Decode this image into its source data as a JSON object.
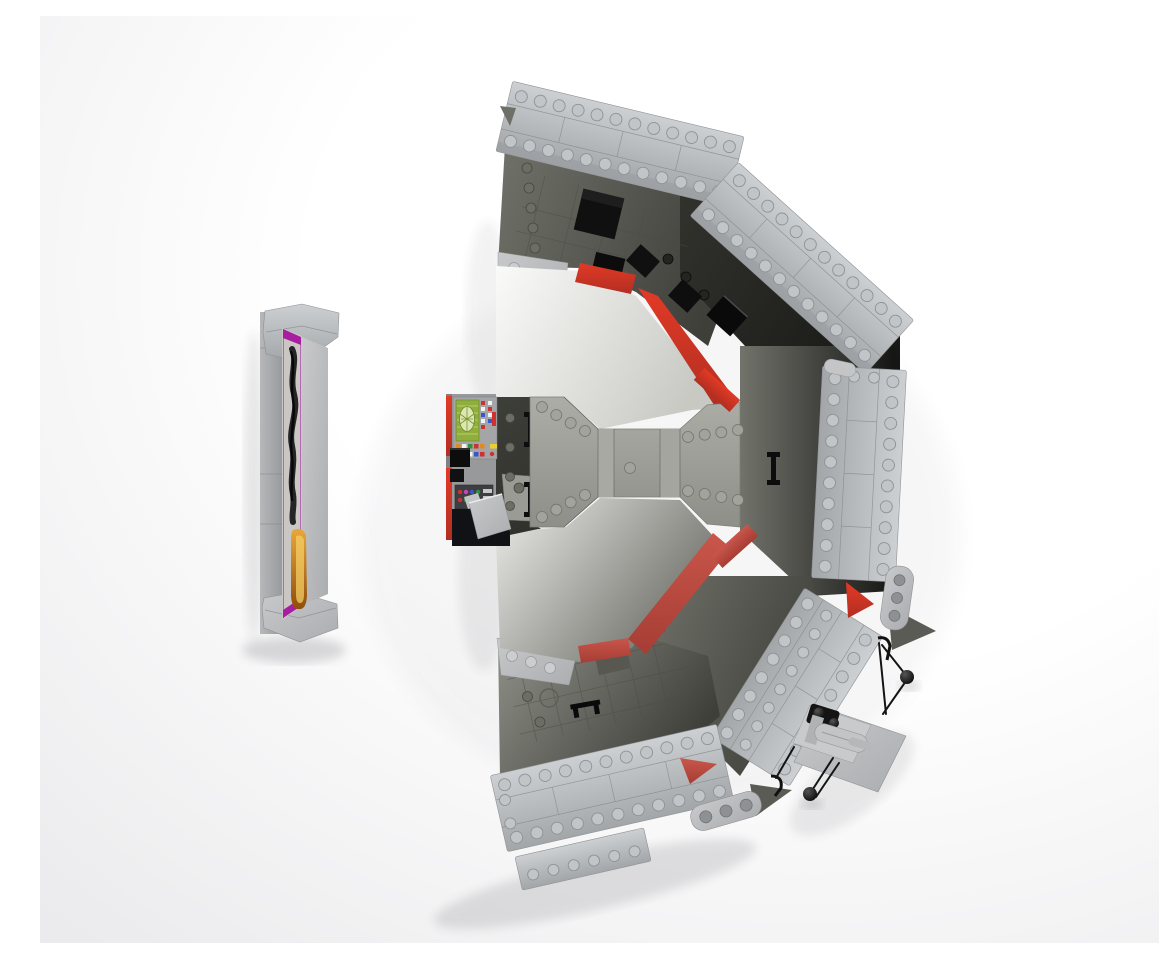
{
  "meta": {
    "type": "3d-render-screenshot",
    "caption": "Top-down 3D render of a gray LEGO diorama: five studded wall segments arranged in a broken ring around a central walkway with red sloped trim, a printed control console with colored buttons, a sensor platform with black ball-tipped antenna rods, and a freestanding panel displaying purple-trimmed artwork of a dark smoke figure above orange flames, on a white studio backdrop."
  },
  "scene": {
    "objects": [
      {
        "name": "artwork-panel",
        "label": "Freestanding gray panel with purple-trimmed artwork: black smoke figure over orange flame"
      },
      {
        "name": "control-console",
        "label": "Printed control console with green gauge screen and colored button tiles"
      },
      {
        "name": "central-walkway",
        "label": "Central studded walkway bridge with red corner slopes"
      },
      {
        "name": "wall-segment-top",
        "label": "Top studded wall segment"
      },
      {
        "name": "wall-segment-upper-right",
        "label": "Upper-right studded wall segment"
      },
      {
        "name": "wall-segment-right",
        "label": "Right studded wall segment"
      },
      {
        "name": "wall-segment-lower-right",
        "label": "Lower-right studded wall segment"
      },
      {
        "name": "wall-segment-bottom",
        "label": "Bottom studded wall segment"
      },
      {
        "name": "red-trim",
        "label": "Red sloped trim strips along inner floor edges"
      },
      {
        "name": "sensor-platform",
        "label": "Gray platform with cylinder, ball joints and thin black antenna rods"
      },
      {
        "name": "fallen-tiles",
        "label": "Loose light-gray tiles leaning by the console"
      }
    ]
  },
  "colors": {
    "bg_center": "#ffffff",
    "bg_edge": "#ebebed",
    "wall_hi": "#cdd0d3",
    "wall_lo": "#a3a6a9",
    "wall_edge": "#8f9295",
    "plate_hi": "#c7c9cb",
    "plate_lo": "#abadb0",
    "floor_light": "#91928a",
    "floor_mid": "#72736b",
    "floor_dark": "#3e3f39",
    "floor_deep": "#33332e",
    "floor_black": "#151514",
    "wedge_dark": "#2e2f2a",
    "bridge_hi": "#acada6",
    "bridge_lo": "#8e8f88",
    "smooth_hi": "#fafaf9",
    "smooth_mid": "#c9c9c4",
    "smooth_lo": "#6f6f68",
    "red_hi": "#e23a26",
    "red_lo": "#b22e21",
    "red_muted": "#c9564b",
    "red_muted_lo": "#a63d34",
    "purple": "#a81ea0",
    "picture_bg": "#c9c6c3",
    "smoke": "#17171a",
    "flame_hi": "#e8a838",
    "flame_lo": "#8f4e0c",
    "flame_glow": "#f4cd66",
    "console_screen": "#8fae3e",
    "screen_light": "#dce8b4",
    "black": "#0d0d0d",
    "btn_orange": "#e08a20",
    "btn_green": "#2f9040",
    "btn_red": "#cf3030",
    "btn_blue": "#3a56c8",
    "btn_yellow": "#e8d030",
    "btn_white": "#f2f2f2",
    "dot_magenta": "#d040c0",
    "dot_purple": "#8040c8"
  }
}
